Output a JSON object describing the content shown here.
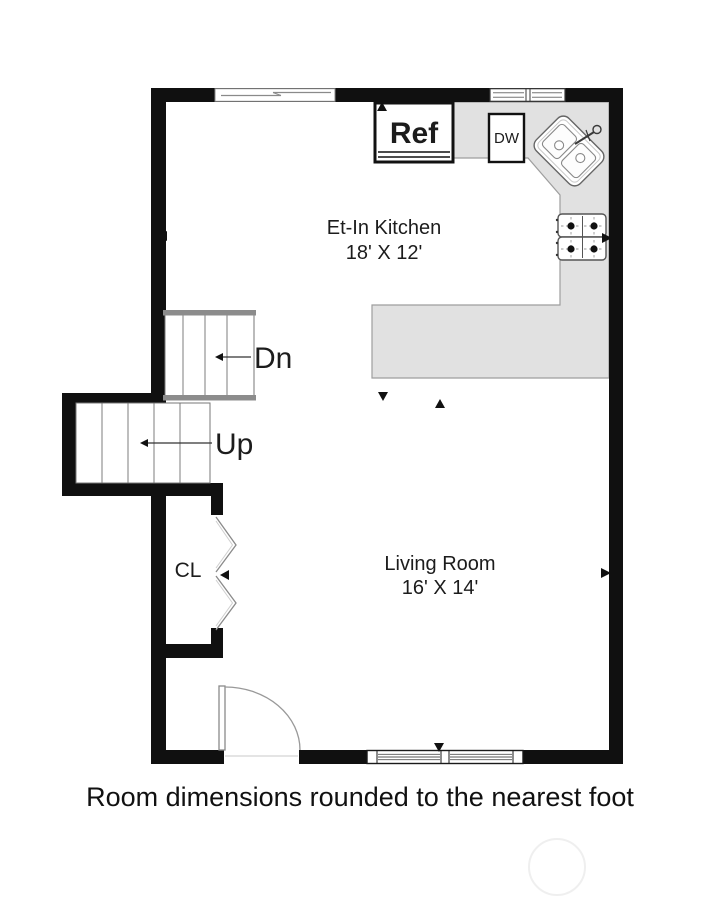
{
  "caption": "Room dimensions rounded to the nearest foot",
  "floorplan": {
    "kitchen": {
      "name": "Et-In Kitchen",
      "dims": "18' X 12'"
    },
    "living_room": {
      "name": "Living Room",
      "dims": "16' X 14'"
    },
    "closet": {
      "label": "CL"
    },
    "stairs": {
      "down": "Dn",
      "up": "Up"
    },
    "appliances": {
      "refrigerator": "Ref",
      "dishwasher": "DW"
    },
    "colors": {
      "wall": "#101010",
      "counter_fill": "#e1e1e1",
      "counter_stroke": "#9e9e9e",
      "stair_rail": "#8c8c8c",
      "text": "#1c1c1c"
    }
  }
}
